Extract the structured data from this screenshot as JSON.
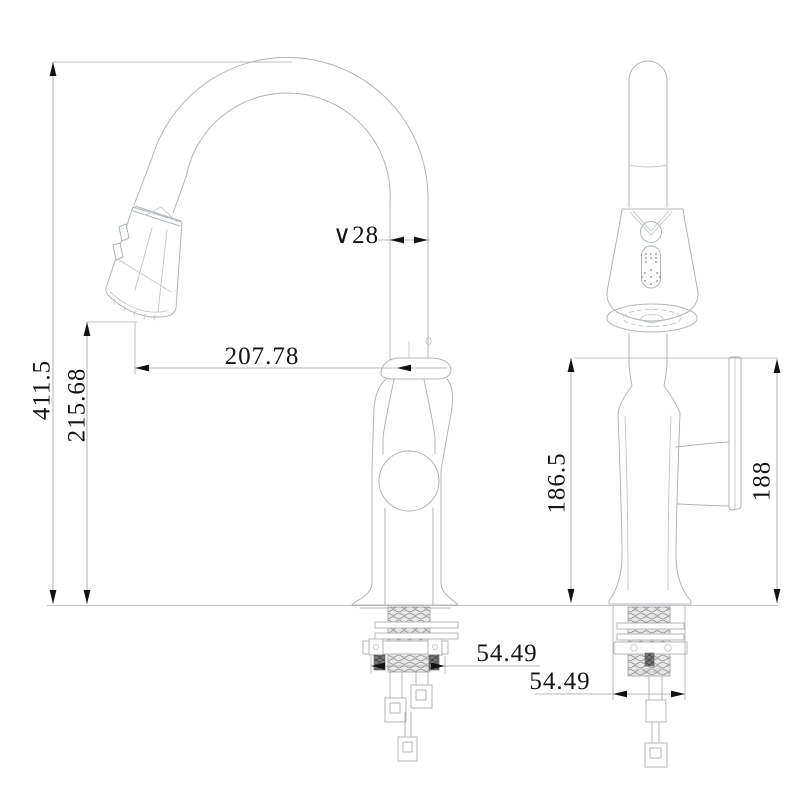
{
  "drawing": {
    "type": "technical-drawing",
    "subject": "pull-down kitchen faucet, two orthographic views",
    "background_color": "#ffffff",
    "line_color": "#b0b5b9",
    "dimension_line_color": "#9aa0a5",
    "text_color": "#141414"
  },
  "views": {
    "side_view_label": "side view",
    "front_view_label": "front view"
  },
  "dims": {
    "overall_height": "411.5",
    "spray_tip_height": "215.68",
    "reach": "207.78",
    "spout_diameter": "∨28",
    "deck_to_spray_height": "186.5",
    "handle_height": "188",
    "shank_width_side": "54.49",
    "shank_width_front": "54.49"
  }
}
